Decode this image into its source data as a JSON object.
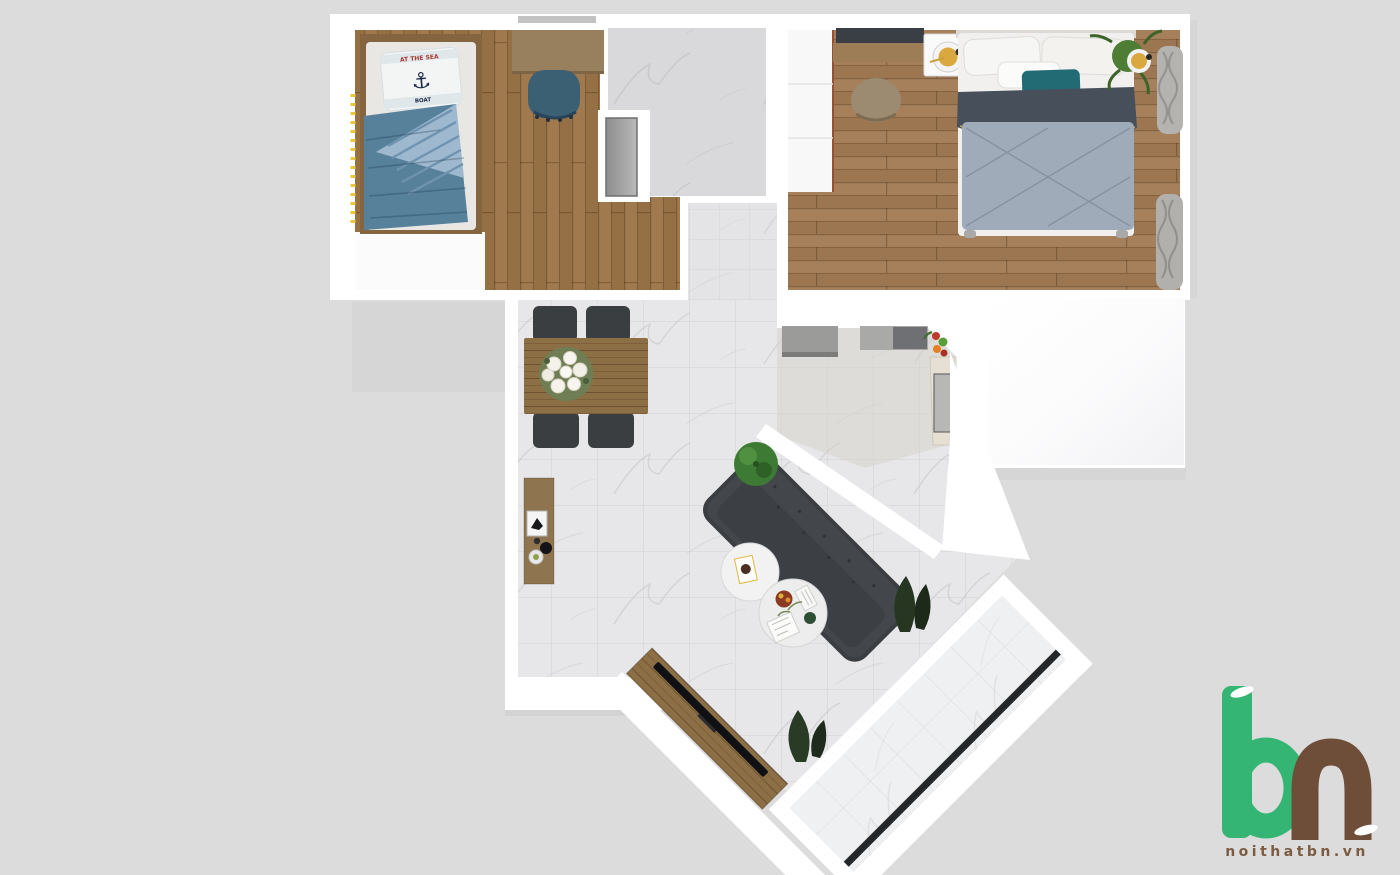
{
  "brand": {
    "website": "noithatbn.vn",
    "letter_b": "b",
    "letter_n": "n",
    "green": "#35b573",
    "brown": "#6f4e39",
    "text_color": "#7b5c41"
  },
  "decor_text": {
    "pillow_line1": "AT THE SEA",
    "pillow_anchor_icon": "⚓",
    "pillow_line2": "BOAT"
  },
  "palette": {
    "background": "#dcdcdc",
    "walls": "#ffffff",
    "wood_floor_kids": "#a07a4e",
    "wood_floor_master": "#a5805a",
    "marble_floor": "#e7e7e9",
    "bathroom_marble": "#d9d9db",
    "sofa_gray": "#43474b",
    "duvet_blue": "#57809b",
    "duvet_stripe": "#9db8cf",
    "quilt_gray_blue": "#9fabb8",
    "blanket_slate": "#474f5a",
    "teal_pillow": "#236b74",
    "gold_lamp": "#d9a93f",
    "counter_gray": "#9b9b99",
    "door_track_black": "#24272a",
    "plant_green": "#3d7a33"
  },
  "scene": {
    "type": "apartment-floor-plan-3d-top-view",
    "rooms": [
      "kids-bedroom",
      "bathroom",
      "hallway",
      "master-bedroom",
      "kitchen",
      "living-dining",
      "balcony",
      "white-room"
    ],
    "furniture": [
      "single-bed",
      "desk",
      "desk-chair",
      "double-bed",
      "nightstand",
      "vanity-stool",
      "wardrobe",
      "kitchen-counters",
      "fridge",
      "dining-table",
      "dining-chairs",
      "flower-centerpiece",
      "console-shelf",
      "sofa",
      "coffee-tables",
      "tv-console",
      "plants",
      "curtains"
    ]
  }
}
